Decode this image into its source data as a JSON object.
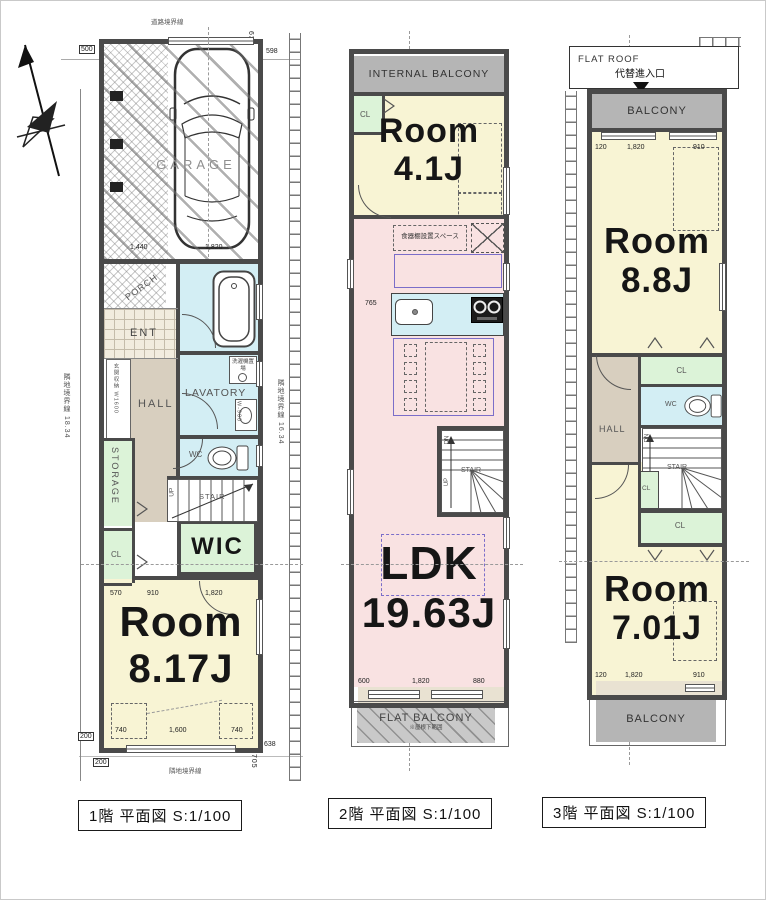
{
  "colors": {
    "wall": "#4a4a4a",
    "room_yellow": "#f8f4d4",
    "ldk_pink": "#f9e2e2",
    "wet_blue": "#d3eef4",
    "closet_green": "#dcf3d8",
    "hall_tan": "#d8cfbf",
    "balcony_gray": "#b5b5b5",
    "furniture_purple": "#7b6ec9"
  },
  "f1": {
    "caption": "1階 平面図 S:1/100",
    "boundary": {
      "top": "道路境界線",
      "left": "隣地境界線 18.34",
      "right": "隣地境界線 16.34",
      "bottom": "隣地境界線"
    },
    "garage": "GARAGE",
    "porch": "PORCH",
    "ent": "ENT",
    "ent_storage": "玄関収納 W1600",
    "hall": "HALL",
    "lavatory": "LAVATORY",
    "laundry": "洗濯機置場",
    "vanity": "W-900",
    "storage": "STORAGE",
    "wc": "WC",
    "up": "UP",
    "stair": "STAIR",
    "cl": "CL",
    "wic": "WIC",
    "room": "Room",
    "room_size": "8.17J",
    "dim_500": "500",
    "dim_598": "598",
    "dim_635": "635",
    "dim_1440": "1,440",
    "dim_1820_garage": "1,820",
    "dim_570": "570",
    "dim_910": "910",
    "dim_1820_mid": "1,820",
    "dim_740_l": "740",
    "dim_1600": "1,600",
    "dim_740_r": "740",
    "dim_638": "638",
    "dim_705": "705",
    "dim_200_a": "200",
    "dim_200_b": "200"
  },
  "f2": {
    "caption": "2階 平面図 S:1/100",
    "internal_balcony": "INTERNAL BALCONY",
    "cl": "CL",
    "room": "Room",
    "room_size": "4.1J",
    "cupboard_space": "食器棚設置スペース",
    "dim_765": "765",
    "dn": "DN",
    "up": "UP",
    "stair": "STAIR",
    "ldk": "LDK",
    "ldk_size": "19.63J",
    "dim_600": "600",
    "dim_1820": "1,820",
    "dim_880": "880",
    "flat_balcony": "FLAT BALCONY",
    "flat_balcony_note": "※屋根下範囲"
  },
  "f3": {
    "caption": "3階 平面図 S:1/100",
    "flat_roof": "FLAT ROOF",
    "entry_label": "代替進入口",
    "balcony_top": "BALCONY",
    "dim_top_120": "120",
    "dim_top_1820": "1,820",
    "dim_top_910": "910",
    "room_a": "Room",
    "room_a_size": "8.8J",
    "cl_a": "CL",
    "hall": "HALL",
    "wc": "WC",
    "dn": "DN",
    "stair": "STAIR",
    "cl_b": "CL",
    "cl_c": "CL",
    "room_b": "Room",
    "room_b_size": "7.01J",
    "dim_bot_120": "120",
    "dim_bot_1820": "1,820",
    "dim_bot_910": "910",
    "balcony_bottom": "BALCONY"
  }
}
